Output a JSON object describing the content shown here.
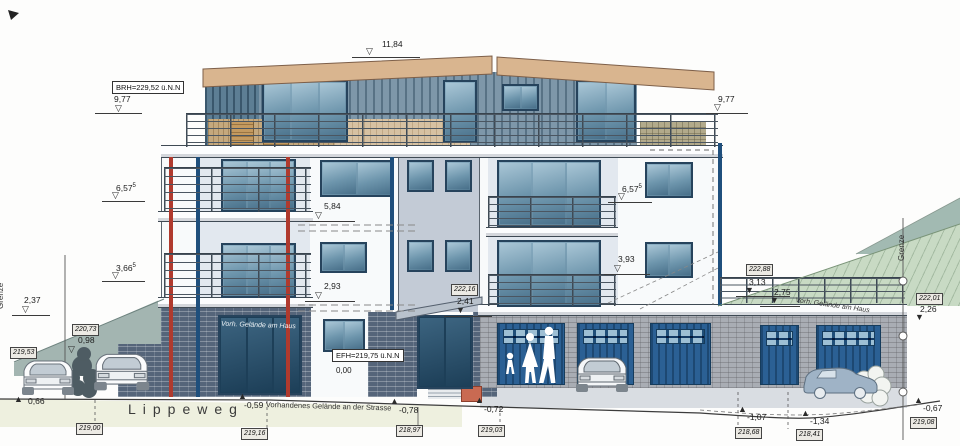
{
  "drawing": {
    "street": {
      "name": "Lippeweg",
      "ground_note": "Vorhandenes Gelände an der Strasse"
    },
    "boundary": {
      "left": "Grenze",
      "right": "Grenze"
    },
    "terrain_notes": {
      "left": "Vorh. Gelände am Haus",
      "right": "Vorh. Gelände am Haus"
    },
    "reference": {
      "brh": "BRH=229,52 ü.N.N",
      "efh": "EFH=219,75 ü.N.N",
      "efh_zero": "0,00"
    },
    "colors": {
      "roof": "#d9b58f",
      "siding": "#7e97a9",
      "facade": "#f8fafb",
      "tower": "#c3cbd6",
      "glass": "#6f9ab2",
      "garage_door": "#2b6094",
      "brick_dark": "#55657a",
      "brick_light": "#a9adb4",
      "terrain_green": "#c8dac4",
      "terrain_teal": "#a2bab2",
      "street": "#eef0df",
      "accent_red": "#b03a2e",
      "accent_blue": "#1f4f7c"
    },
    "level_markers": [
      {
        "id": "ridge",
        "label": "11,84",
        "sup": null,
        "lx": 382,
        "ly": 40,
        "tri": "open",
        "tx": 366,
        "ty": 47,
        "ul": [
          352,
          420,
          57
        ]
      },
      {
        "id": "brh-left",
        "label": "9,77",
        "sup": null,
        "lx": 114,
        "ly": 95,
        "tri": "open",
        "tx": 115,
        "ty": 104,
        "ul": [
          95,
          142,
          113
        ]
      },
      {
        "id": "floor2-left",
        "label": "6,57",
        "sup": "5",
        "lx": 116,
        "ly": 182,
        "tri": "open",
        "tx": 112,
        "ty": 191,
        "ul": [
          102,
          145,
          201
        ]
      },
      {
        "id": "floor1-left",
        "label": "3,66",
        "sup": "5",
        "lx": 116,
        "ly": 262,
        "tri": "open",
        "tx": 112,
        "ty": 271,
        "ul": [
          102,
          145,
          281
        ]
      },
      {
        "id": "wall-left",
        "label": "2,37",
        "sup": null,
        "lx": 24,
        "ly": 296,
        "tri": "open",
        "tx": 22,
        "ty": 305,
        "ul": [
          12,
          50,
          315
        ]
      },
      {
        "id": "gelaende-left",
        "label": "0,98",
        "sup": null,
        "lx": 78,
        "ly": 336,
        "tri": "open",
        "tx": 68,
        "ty": 345,
        "ul": null
      },
      {
        "id": "street-1",
        "label": "0,66",
        "sup": null,
        "lx": 28,
        "ly": 397,
        "tri": "up",
        "tx": 14,
        "ty": 395,
        "ul": null
      },
      {
        "id": "mid-upper",
        "label": "5,84",
        "sup": null,
        "lx": 324,
        "ly": 202,
        "tri": "open",
        "tx": 315,
        "ty": 211,
        "ul": [
          305,
          355,
          221
        ]
      },
      {
        "id": "mid-lower",
        "label": "2,93",
        "sup": null,
        "lx": 324,
        "ly": 282,
        "tri": "open",
        "tx": 315,
        "ty": 291,
        "ul": [
          305,
          355,
          301
        ]
      },
      {
        "id": "entry-canopy",
        "label": "2,41",
        "sup": null,
        "lx": 457,
        "ly": 297,
        "tri": "down",
        "tx": 456,
        "ty": 306,
        "ul": [
          444,
          492,
          316
        ]
      },
      {
        "id": "brh-right",
        "label": "9,77",
        "sup": null,
        "lx": 718,
        "ly": 95,
        "tri": "open",
        "tx": 714,
        "ty": 103,
        "ul": [
          706,
          748,
          113
        ]
      },
      {
        "id": "floor2-right",
        "label": "6,57",
        "sup": "5",
        "lx": 622,
        "ly": 183,
        "tri": "open",
        "tx": 618,
        "ty": 192,
        "ul": [
          608,
          652,
          202
        ]
      },
      {
        "id": "floor1-right",
        "label": "3,93",
        "sup": null,
        "lx": 618,
        "ly": 255,
        "tri": "open",
        "tx": 614,
        "ty": 264,
        "ul": [
          604,
          650,
          274
        ]
      },
      {
        "id": "garage-roof-1",
        "label": "3,13",
        "sup": null,
        "lx": 749,
        "ly": 278,
        "tri": "down",
        "tx": 745,
        "ty": 286,
        "ul": [
          736,
          790,
          296
        ]
      },
      {
        "id": "garage-roof-2",
        "label": "2,75",
        "sup": null,
        "lx": 774,
        "ly": 288,
        "tri": "down",
        "tx": 770,
        "ty": 296,
        "ul": [
          760,
          800,
          306
        ]
      },
      {
        "id": "gelaende-right",
        "label": "2,26",
        "sup": null,
        "lx": 920,
        "ly": 305,
        "tri": "down",
        "tx": 915,
        "ty": 313,
        "ul": null
      },
      {
        "id": "street-2",
        "label": "-0,59",
        "sup": null,
        "lx": 244,
        "ly": 401,
        "tri": "up",
        "tx": 238,
        "ty": 392,
        "ul": null
      },
      {
        "id": "street-3",
        "label": "-0,78",
        "sup": null,
        "lx": 399,
        "ly": 406,
        "tri": "up",
        "tx": 390,
        "ty": 397,
        "ul": null
      },
      {
        "id": "street-4",
        "label": "-0,72",
        "sup": null,
        "lx": 484,
        "ly": 405,
        "tri": "up",
        "tx": 475,
        "ty": 396,
        "ul": null
      },
      {
        "id": "ground-5",
        "label": "-1,07",
        "sup": null,
        "lx": 747,
        "ly": 413,
        "tri": "up",
        "tx": 738,
        "ty": 405,
        "ul": null
      },
      {
        "id": "ground-6",
        "label": "-1,34",
        "sup": null,
        "lx": 810,
        "ly": 417,
        "tri": "up",
        "tx": 801,
        "ty": 409,
        "ul": null
      },
      {
        "id": "ground-7",
        "label": "-0,67",
        "sup": null,
        "lx": 923,
        "ly": 404,
        "tri": "up",
        "tx": 914,
        "ty": 396,
        "ul": null
      }
    ],
    "elevation_boxes": [
      {
        "id": "e-220-73",
        "label": "220,73",
        "x": 72,
        "y": 324
      },
      {
        "id": "e-219-53",
        "label": "219,53",
        "x": 10,
        "y": 347
      },
      {
        "id": "e-222-16",
        "label": "222,16",
        "x": 451,
        "y": 284
      },
      {
        "id": "e-222-88",
        "label": "222,88",
        "x": 746,
        "y": 264
      },
      {
        "id": "e-222-01",
        "label": "222,01",
        "x": 916,
        "y": 293
      },
      {
        "id": "e-219-00",
        "label": "219,00",
        "x": 76,
        "y": 423
      },
      {
        "id": "e-219-16",
        "label": "219,16",
        "x": 241,
        "y": 428
      },
      {
        "id": "e-218-97",
        "label": "218,97",
        "x": 396,
        "y": 425
      },
      {
        "id": "e-219-03",
        "label": "219,03",
        "x": 478,
        "y": 425
      },
      {
        "id": "e-218-68",
        "label": "218,68",
        "x": 735,
        "y": 427
      },
      {
        "id": "e-218-41",
        "label": "218,41",
        "x": 796,
        "y": 429
      },
      {
        "id": "e-219-08",
        "label": "219,08",
        "x": 910,
        "y": 417
      }
    ]
  }
}
